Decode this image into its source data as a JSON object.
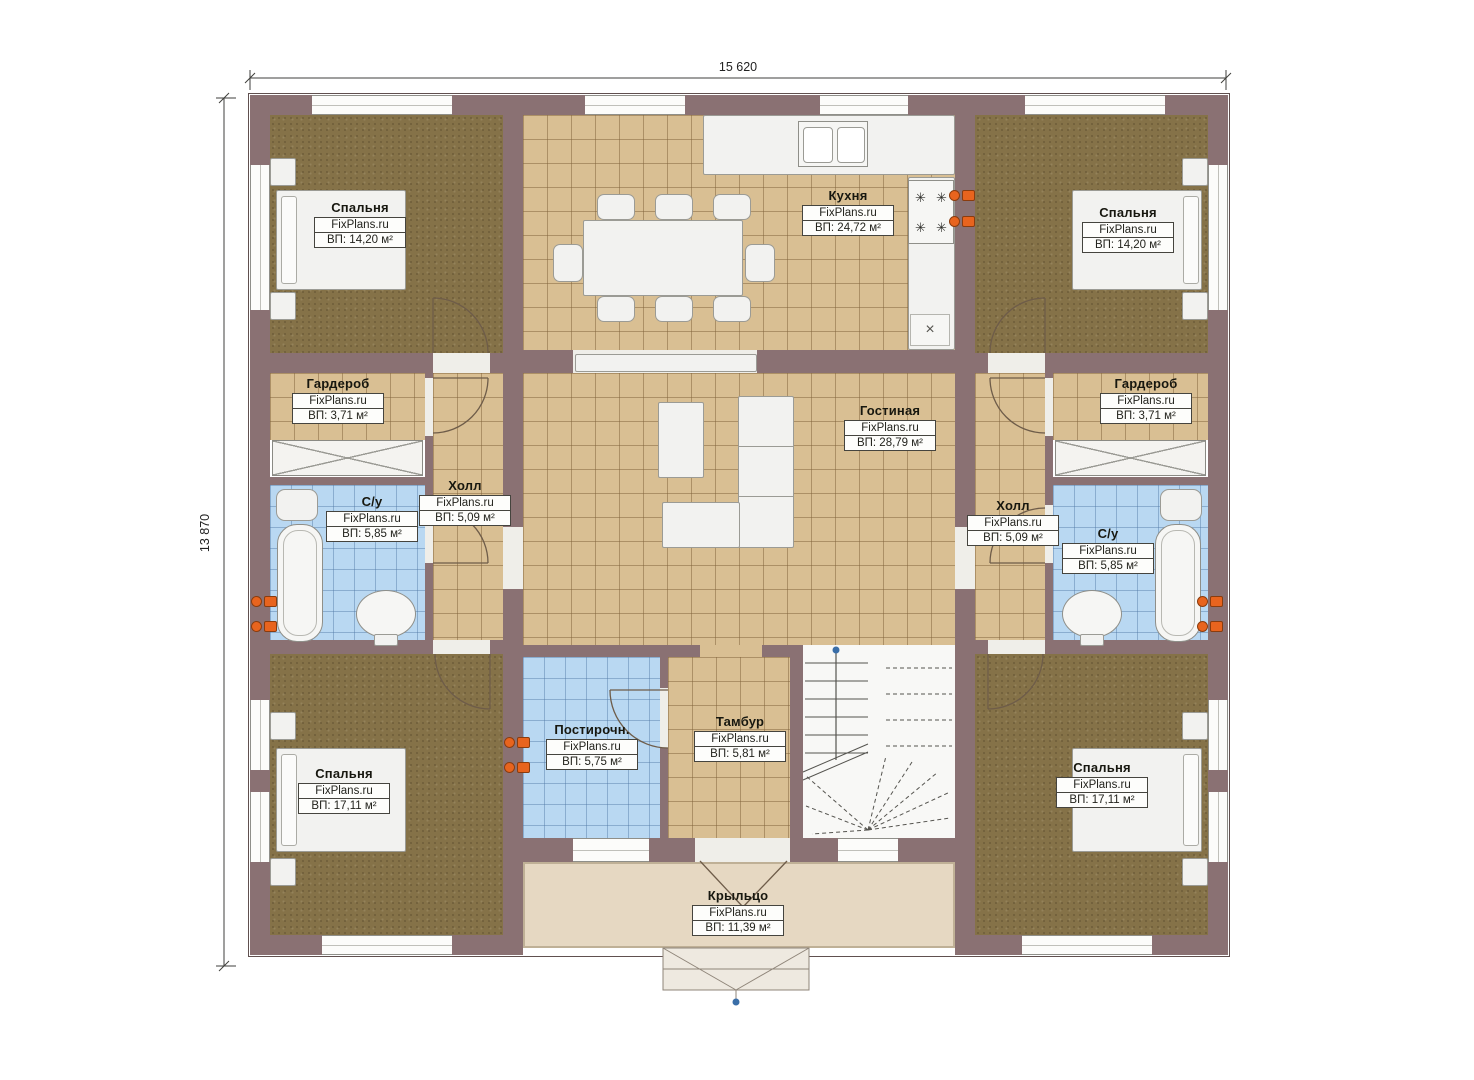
{
  "brand": "FixPlans.ru",
  "dimensions": {
    "top": "15 620",
    "left": "13 870"
  },
  "rooms": [
    {
      "key": "bedroom-top-left",
      "name": "Спальня",
      "area": "ВП: 14,20 м²"
    },
    {
      "key": "kitchen",
      "name": "Кухня",
      "area": "ВП: 24,72 м²"
    },
    {
      "key": "bedroom-top-right",
      "name": "Спальня",
      "area": "ВП: 14,20 м²"
    },
    {
      "key": "wardrobe-left",
      "name": "Гардероб",
      "area": "ВП: 3,71 м²"
    },
    {
      "key": "hall-left",
      "name": "Холл",
      "area": "ВП: 5,09 м²"
    },
    {
      "key": "living-room",
      "name": "Гостиная",
      "area": "ВП: 28,79 м²"
    },
    {
      "key": "hall-right",
      "name": "Холл",
      "area": "ВП: 5,09 м²"
    },
    {
      "key": "wardrobe-right",
      "name": "Гардероб",
      "area": "ВП: 3,71 м²"
    },
    {
      "key": "bathroom-left",
      "name": "С/у",
      "area": "ВП: 5,85 м²"
    },
    {
      "key": "bathroom-right",
      "name": "С/у",
      "area": "ВП: 5,85 м²"
    },
    {
      "key": "bedroom-bottom-left",
      "name": "Спальня",
      "area": "ВП: 17,11 м²"
    },
    {
      "key": "laundry",
      "name": "Постирочн.",
      "area": "ВП: 5,75 м²"
    },
    {
      "key": "vestibule",
      "name": "Тамбур",
      "area": "ВП: 5,81 м²"
    },
    {
      "key": "bedroom-bottom-right",
      "name": "Спальня",
      "area": "ВП: 17,11 м²"
    },
    {
      "key": "porch",
      "name": "Крыльцо",
      "area": "ВП: 11,39 м²"
    }
  ],
  "colors": {
    "wall": "#8a7173",
    "carpet": "#857248",
    "tile_tan": "#d9bf93",
    "tile_blue": "#b9d8f2",
    "porch_floor": "#e6d8c2",
    "accent_orange": "#e8641e",
    "marker_blue": "#3a6ea8"
  }
}
